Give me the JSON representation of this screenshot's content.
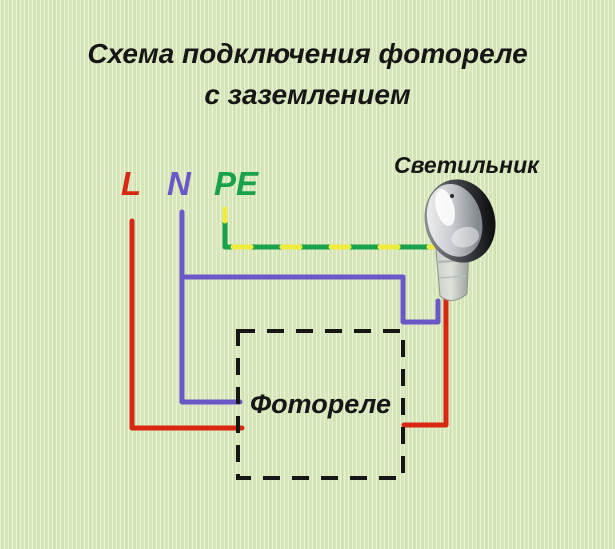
{
  "title": {
    "line1": "Схема подключения фотореле",
    "line2": "с заземлением"
  },
  "terminals": {
    "l": "L",
    "n": "N",
    "pe": "PE"
  },
  "lamp": {
    "label": "Светильник"
  },
  "photorelay": {
    "label": "Фотореле"
  },
  "colors": {
    "background": "#d7e6b8",
    "phase_red": "#d92812",
    "neutral_blue": "#6a58c8",
    "earth_green": "#17a24b",
    "earth_yellow": "#f0ec3f",
    "text_black": "#161616"
  },
  "wires": [
    {
      "name": "phase-L-to-photorelay",
      "color": "red",
      "from": "L",
      "to": "Фотореле left side"
    },
    {
      "name": "neutral-N-to-photorelay",
      "color": "blue",
      "from": "N",
      "to": "Фотореле left side"
    },
    {
      "name": "neutral-N-branch-to-lamp",
      "color": "blue",
      "from": "N",
      "to": "Светильник bottom"
    },
    {
      "name": "earth-PE-to-lamp",
      "color": "green-yellow striped",
      "from": "PE",
      "to": "Светильник left side"
    },
    {
      "name": "switched-phase-lamp-to-photorelay",
      "color": "red",
      "from": "Светильник bottom",
      "to": "Фотореле right side"
    }
  ]
}
